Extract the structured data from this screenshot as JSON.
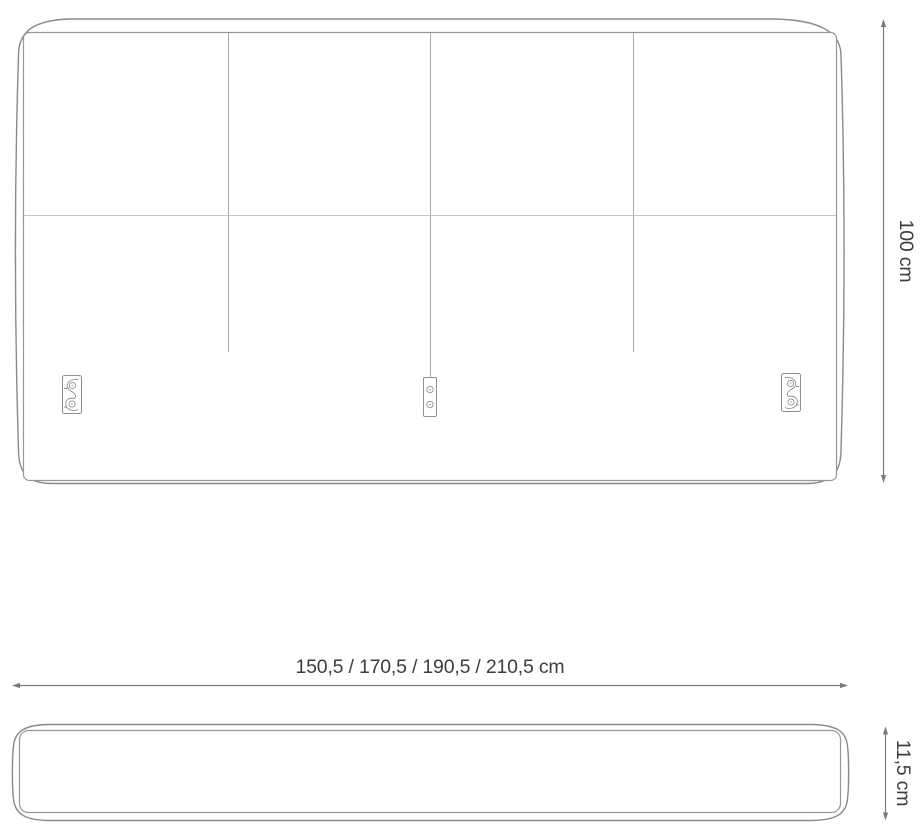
{
  "drawing": {
    "description": "Headboard technical drawing with front view and top view",
    "front_view": {
      "height_label": "100 cm",
      "width_label": "150,5 / 170,5 / 190,5 / 210,5 cm"
    },
    "top_view": {
      "depth_label": "11,5 cm"
    },
    "dimensions": {
      "height": "100 cm",
      "width_options": [
        "150,5 cm",
        "170,5 cm",
        "190,5 cm",
        "210,5 cm"
      ],
      "depth": "11,5 cm"
    },
    "colors": {
      "outline": "#8a8a8a",
      "inner_line": "#979797",
      "seam": "#a9a9a9",
      "seam_horizontal": "#c6c6c6",
      "bracket_line": "#8f8f8f",
      "dimension_line": "#7a7a7a",
      "label_text": "#3d3d3d",
      "background": "#ffffff"
    }
  }
}
